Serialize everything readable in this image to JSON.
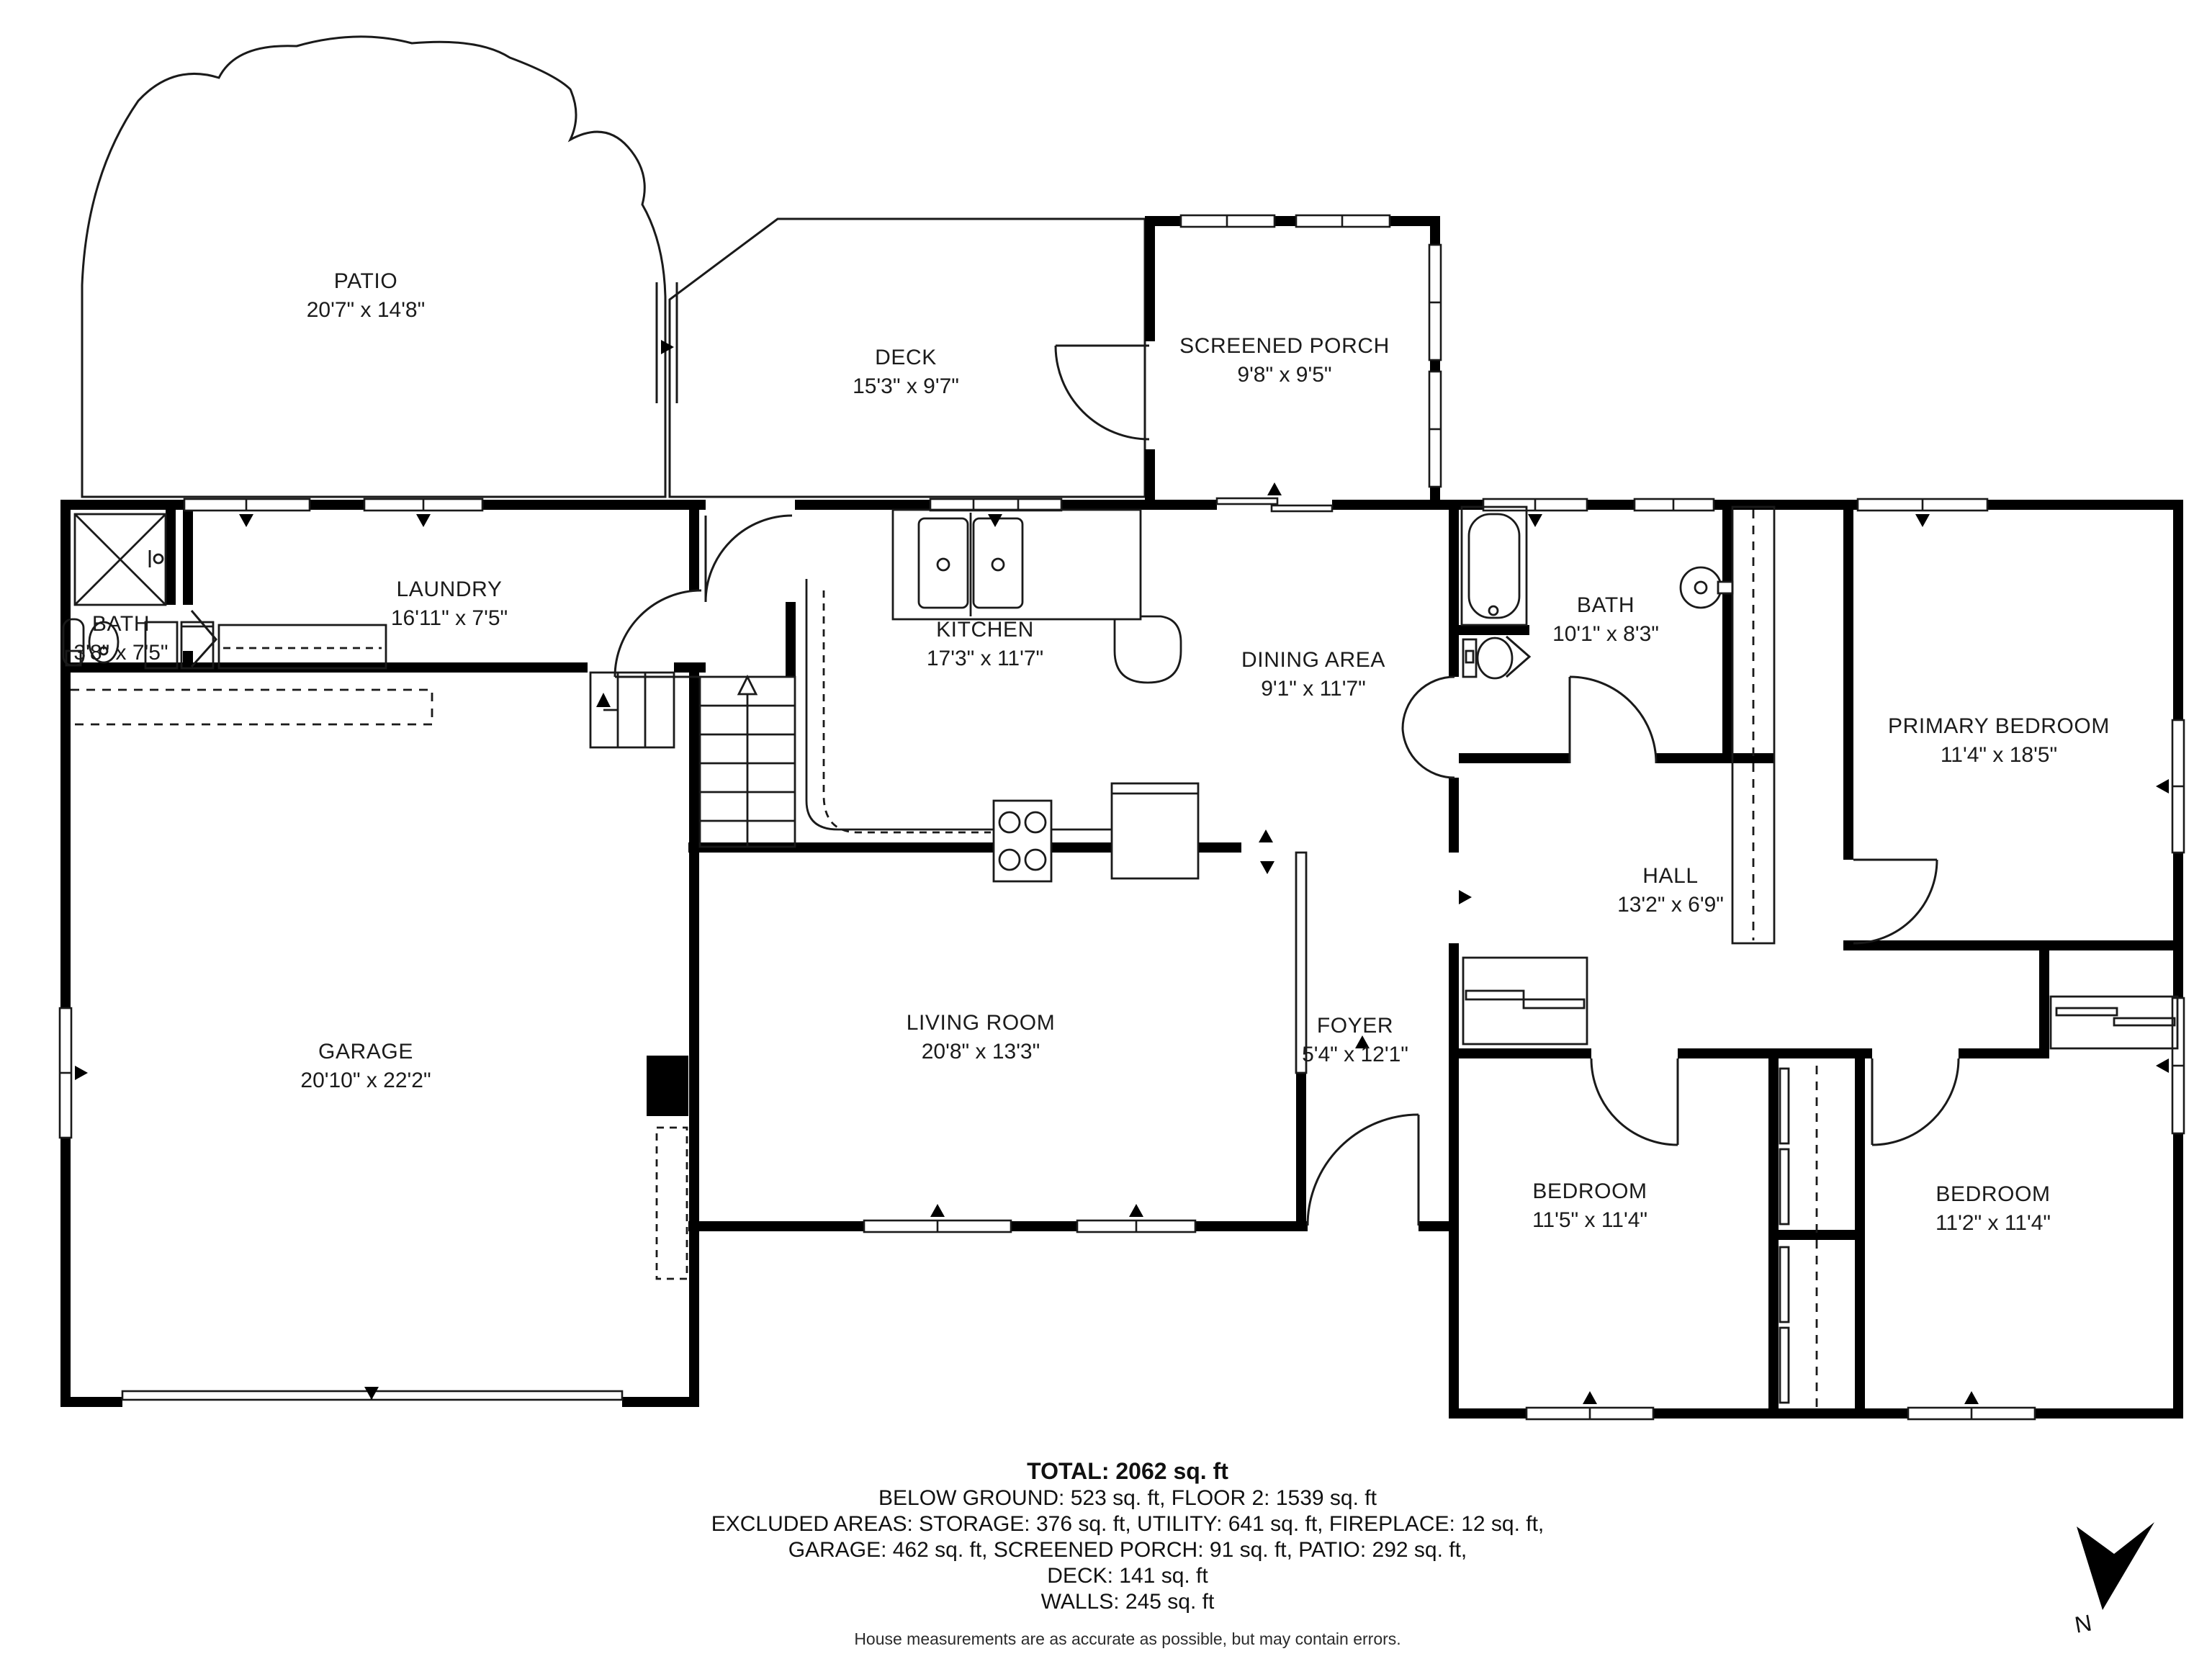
{
  "document": {
    "type": "floor-plan"
  },
  "rooms": [
    {
      "id": "patio",
      "name": "PATIO",
      "dims": "20'7\" x 14'8\""
    },
    {
      "id": "deck",
      "name": "DECK",
      "dims": "15'3\" x 9'7\""
    },
    {
      "id": "screened-porch",
      "name": "SCREENED PORCH",
      "dims": "9'8\" x 9'5\""
    },
    {
      "id": "laundry",
      "name": "LAUNDRY",
      "dims": "16'11\" x 7'5\""
    },
    {
      "id": "bath-small",
      "name": "BATH",
      "dims": "3'8\" x 7'5\""
    },
    {
      "id": "kitchen",
      "name": "KITCHEN",
      "dims": "17'3\" x 11'7\""
    },
    {
      "id": "dining-area",
      "name": "DINING AREA",
      "dims": "9'1\" x 11'7\""
    },
    {
      "id": "bath",
      "name": "BATH",
      "dims": "10'1\" x 8'3\""
    },
    {
      "id": "primary-bedroom",
      "name": "PRIMARY BEDROOM",
      "dims": "11'4\" x 18'5\""
    },
    {
      "id": "garage",
      "name": "GARAGE",
      "dims": "20'10\" x 22'2\""
    },
    {
      "id": "living-room",
      "name": "LIVING ROOM",
      "dims": "20'8\" x 13'3\""
    },
    {
      "id": "foyer",
      "name": "FOYER",
      "dims": "5'4\" x 12'1\""
    },
    {
      "id": "hall",
      "name": "HALL",
      "dims": "13'2\" x 6'9\""
    },
    {
      "id": "bedroom-1",
      "name": "BEDROOM",
      "dims": "11'5\" x 11'4\""
    },
    {
      "id": "bedroom-2",
      "name": "BEDROOM",
      "dims": "11'2\" x 11'4\""
    }
  ],
  "summary": {
    "total": "TOTAL: 2062 sq. ft",
    "lines": [
      "BELOW GROUND: 523 sq. ft, FLOOR 2: 1539 sq. ft",
      "EXCLUDED AREAS: STORAGE: 376 sq. ft, UTILITY: 641 sq. ft, FIREPLACE: 12 sq. ft,",
      "GARAGE: 462 sq. ft, SCREENED PORCH: 91 sq. ft, PATIO: 292 sq. ft,",
      "DECK: 141 sq. ft",
      "WALLS: 245 sq. ft"
    ],
    "disclaimer": "House measurements are as accurate as possible, but may contain errors."
  },
  "compass": {
    "label": "N"
  },
  "colors": {
    "wall": "#000000",
    "line": "#1a1a1a",
    "text": "#1b1b1b"
  }
}
